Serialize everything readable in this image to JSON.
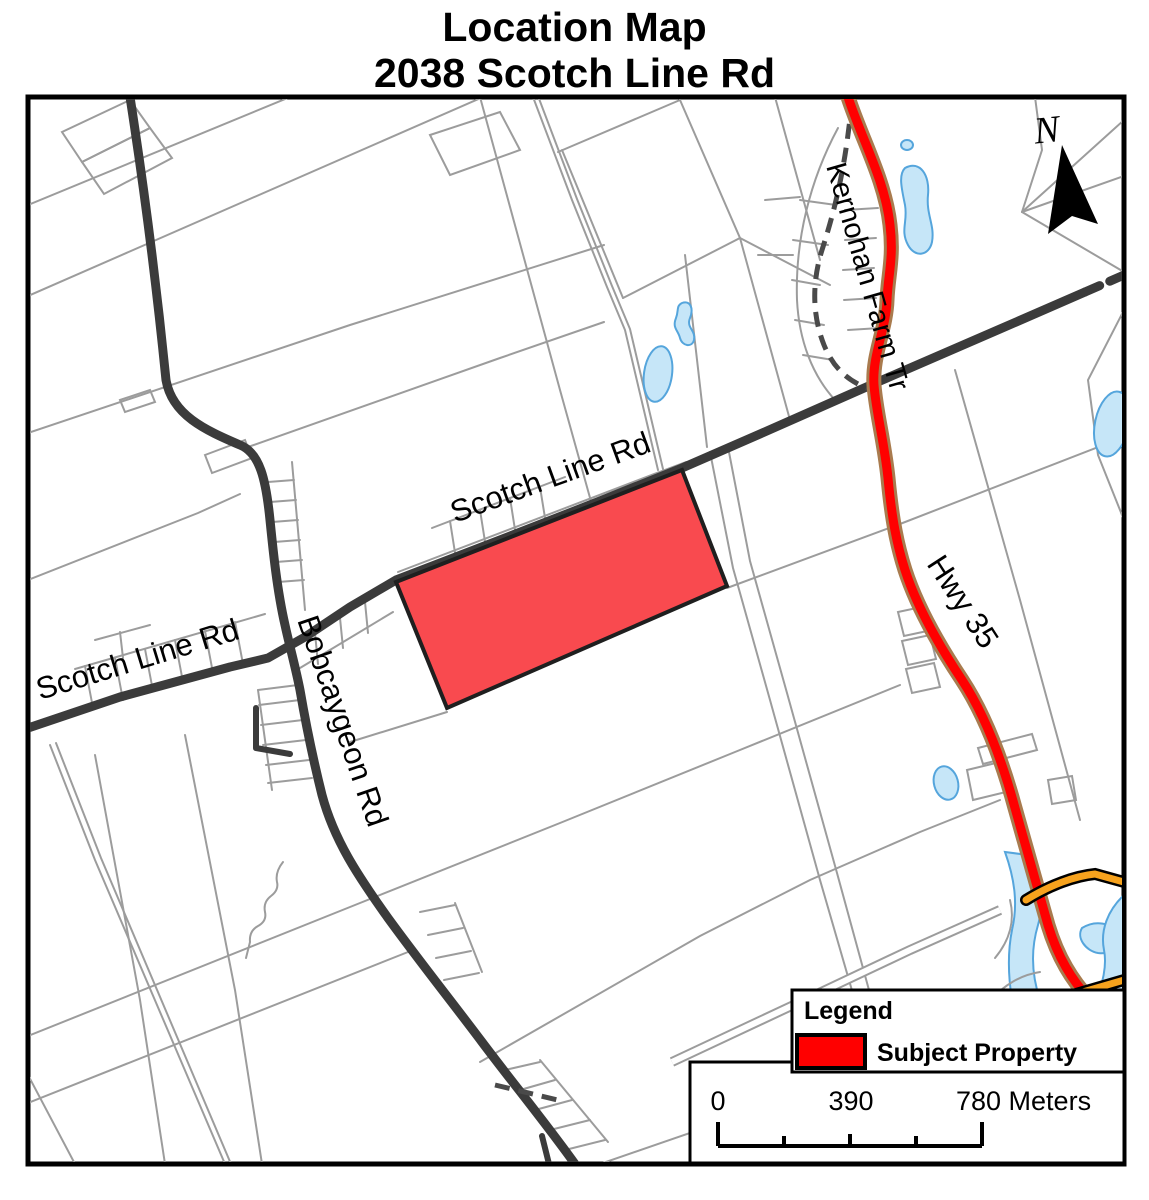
{
  "title": {
    "line1": "Location Map",
    "line2": "2038 Scotch Line Rd"
  },
  "map": {
    "north_label": "N",
    "road_labels": {
      "scotch_line_west": "Scotch Line Rd",
      "scotch_line_center": "Scotch Line Rd",
      "bobcaygeon": "Bobcaygeon Rd",
      "kernohan": "Kernohan Farm Tr",
      "hwy35": "Hwy 35"
    }
  },
  "legend": {
    "title": "Legend",
    "items": [
      {
        "label": "Subject Property",
        "swatch_color": "#FF0000"
      }
    ]
  },
  "scale_bar": {
    "labels": [
      "0",
      "390",
      "780 Meters"
    ]
  },
  "colors": {
    "subject_property": "#FF0000",
    "subject_property_fill": "#F94A4F",
    "highway": "#FF0000",
    "highway_casing": "#A97B4E",
    "major_road": "#3B3B3B",
    "minor_line": "#9C9C9C",
    "water_fill": "#C6E6F8",
    "water_stroke": "#55A5DC",
    "orange_road": "#F6A21D"
  }
}
